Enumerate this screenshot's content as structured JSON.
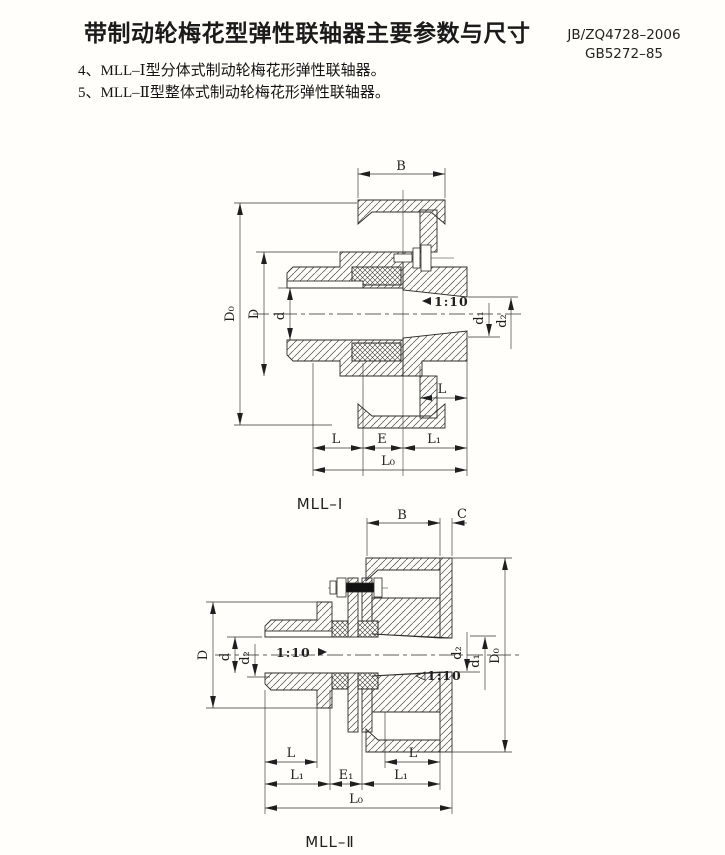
{
  "page": {
    "title": "带制动轮梅花型弹性联轴器主要参数与尺寸",
    "standards": [
      "JB/ZQ4728–2006",
      "GB5272–85"
    ],
    "notes": [
      "4、MLL–Ⅰ型分体式制动轮梅花形弹性联轴器。",
      "5、MLL–Ⅱ型整体式制动轮梅花形弹性联轴器。"
    ]
  },
  "fig1": {
    "caption": "MLL–Ⅰ",
    "dims": {
      "B": "B",
      "D0": "D₀",
      "D": "D",
      "d": "d",
      "d1": "d₁",
      "d2": "d₂",
      "taper": "1:10",
      "L_hub": "L",
      "L": "L",
      "E": "E",
      "L1": "L₁",
      "L0": "L₀"
    }
  },
  "fig2": {
    "caption": "MLL–Ⅱ",
    "dims": {
      "B": "B",
      "C": "C",
      "D": "D",
      "d": "d",
      "d2l": "d₂",
      "taper_l": "1:10",
      "taper_r": "1:10",
      "d2r": "d₂",
      "d1": "d₁",
      "D0": "D₀",
      "L_l": "L",
      "L_r": "L",
      "L1_l": "L₁",
      "E1": "E₁",
      "L1_r": "L₁",
      "L0": "L₀"
    }
  },
  "colors": {
    "ink": "#1f1f1f",
    "line": "#2b2b2b",
    "hatch": "#4d4d4d",
    "paper": "#fffefa"
  }
}
